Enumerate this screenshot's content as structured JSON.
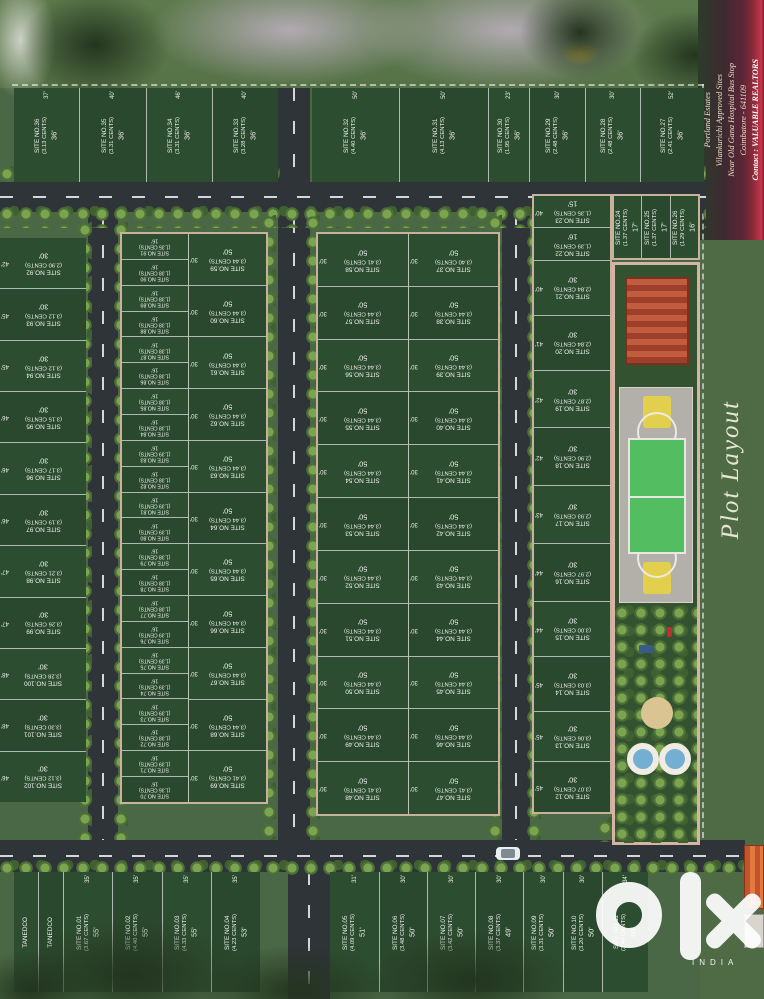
{
  "side_label": "Plot Layout",
  "watermark": {
    "brand": "olx",
    "country": "INDIA"
  },
  "banner": {
    "lines": [
      "Portland Estates",
      "Vilankurichi Approved Sites",
      "Near Old Gana Hospital Bus Stop",
      "Coimbatore - 641109",
      "Contact : VALUABLE REALTORS"
    ]
  },
  "plot_groups": {
    "top_left": [
      {
        "n": "SITE NO.36",
        "c": "(3.13 CENTS)",
        "f": "36'",
        "s": "37'"
      },
      {
        "n": "SITE NO.35",
        "c": "(3.31 CENTS)",
        "f": "36'",
        "s": "40'"
      },
      {
        "n": "SITE NO.34",
        "c": "(3.31 CENTS)",
        "f": "36'",
        "s": "46'"
      },
      {
        "n": "SITE NO.33",
        "c": "(3.28 CENTS)",
        "f": "36'",
        "s": "40'"
      }
    ],
    "top_right": [
      {
        "n": "SITE NO.32",
        "c": "(4.40 CENTS)",
        "f": "36'",
        "s": "50'"
      },
      {
        "n": "SITE NO.31",
        "c": "(4.13 CENTS)",
        "f": "36'",
        "s": "50'"
      },
      {
        "n": "SITE NO.30",
        "c": "(1.95 CENTS)",
        "f": "36'",
        "s": "23'"
      },
      {
        "n": "SITE NO.29",
        "c": "(2.48 CENTS)",
        "f": "36'",
        "s": "30'"
      },
      {
        "n": "SITE NO.28",
        "c": "(2.48 CENTS)",
        "f": "36'",
        "s": "30'"
      },
      {
        "n": "SITE NO.27",
        "c": "(2.41 CENTS)",
        "f": "36'",
        "s": "52'"
      }
    ],
    "left_col": [
      {
        "n": "SITE NO.92",
        "c": "(2.90 CENTS)",
        "f": "30'",
        "s": "42'"
      },
      {
        "n": "SITE NO.93",
        "c": "(3.12 CENTS)",
        "f": "30'",
        "s": "45'"
      },
      {
        "n": "SITE NO.94",
        "c": "(3.12 CENTS)",
        "f": "30'",
        "s": "45'"
      },
      {
        "n": "SITE NO.95",
        "c": "(3.15 CENTS)",
        "f": "30'",
        "s": "46'"
      },
      {
        "n": "SITE NO.96",
        "c": "(3.17 CENTS)",
        "f": "30'",
        "s": "46'"
      },
      {
        "n": "SITE NO.97",
        "c": "(3.19 CENTS)",
        "f": "30'",
        "s": "46'"
      },
      {
        "n": "SITE NO.98",
        "c": "(3.21 CENTS)",
        "f": "30'",
        "s": "47'"
      },
      {
        "n": "SITE NO.99",
        "c": "(3.26 CENTS)",
        "f": "30'",
        "s": "47'"
      },
      {
        "n": "SITE NO.100",
        "c": "(3.28 CENTS)",
        "f": "30'",
        "s": "48'"
      },
      {
        "n": "SITE NO.101",
        "c": "(3.30 CENTS)",
        "f": "30'",
        "s": "48'"
      },
      {
        "n": "SITE NO.102",
        "c": "(3.12 CENTS)",
        "f": "30'",
        "s": "46'"
      }
    ],
    "narrow_col": [
      {
        "n": "SITE NO.91",
        "c": "(1.35 CENTS)",
        "f": "16'"
      },
      {
        "n": "SITE NO.90",
        "c": "(1.38 CENTS)",
        "f": "16'"
      },
      {
        "n": "SITE NO.89",
        "c": "(1.38 CENTS)",
        "f": "16'"
      },
      {
        "n": "SITE NO.88",
        "c": "(1.38 CENTS)",
        "f": "16'"
      },
      {
        "n": "SITE NO.87",
        "c": "(1.38 CENTS)",
        "f": "16'"
      },
      {
        "n": "SITE NO.86",
        "c": "(1.38 CENTS)",
        "f": "16'"
      },
      {
        "n": "SITE NO.85",
        "c": "(1.38 CENTS)",
        "f": "16'"
      },
      {
        "n": "SITE NO.84",
        "c": "(1.38 CENTS)",
        "f": "16'"
      },
      {
        "n": "SITE NO.83",
        "c": "(1.39 CENTS)",
        "f": "16'"
      },
      {
        "n": "SITE NO.82",
        "c": "(1.38 CENTS)",
        "f": "16'"
      },
      {
        "n": "SITE NO.81",
        "c": "(1.39 CENTS)",
        "f": "16'"
      },
      {
        "n": "SITE NO.80",
        "c": "(1.39 CENTS)",
        "f": "16'"
      },
      {
        "n": "SITE NO.79",
        "c": "(1.38 CENTS)",
        "f": "16'"
      },
      {
        "n": "SITE NO.78",
        "c": "(1.38 CENTS)",
        "f": "16'"
      },
      {
        "n": "SITE NO.77",
        "c": "(1.38 CENTS)",
        "f": "16'"
      },
      {
        "n": "SITE NO.76",
        "c": "(1.39 CENTS)",
        "f": "16'"
      },
      {
        "n": "SITE NO.75",
        "c": "(1.39 CENTS)",
        "f": "16'"
      },
      {
        "n": "SITE NO.74",
        "c": "(1.39 CENTS)",
        "f": "16'"
      },
      {
        "n": "SITE NO.73",
        "c": "(1.39 CENTS)",
        "f": "16'"
      },
      {
        "n": "SITE NO.72",
        "c": "(1.38 CENTS)",
        "f": "16'"
      },
      {
        "n": "SITE NO.71",
        "c": "(1.39 CENTS)",
        "f": "16'"
      },
      {
        "n": "SITE NO.70",
        "c": "(1.36 CENTS)",
        "f": "16'"
      }
    ],
    "wide_col": [
      {
        "n": "SITE NO.59",
        "c": "(3.44 CENTS)",
        "d": "50'",
        "s": "30'"
      },
      {
        "n": "SITE NO.60",
        "c": "(3.44 CENTS)",
        "d": "50'",
        "s": "30'"
      },
      {
        "n": "SITE NO.61",
        "c": "(3.44 CENTS)",
        "d": "50'",
        "s": "30'"
      },
      {
        "n": "SITE NO.62",
        "c": "(3.44 CENTS)",
        "d": "50'",
        "s": "30'"
      },
      {
        "n": "SITE NO.63",
        "c": "(3.44 CENTS)",
        "d": "50'",
        "s": "30'"
      },
      {
        "n": "SITE NO.64",
        "c": "(3.44 CENTS)",
        "d": "50'",
        "s": "30'"
      },
      {
        "n": "SITE NO.65",
        "c": "(3.44 CENTS)",
        "d": "50'",
        "s": "30'"
      },
      {
        "n": "SITE NO.66",
        "c": "(3.44 CENTS)",
        "d": "50'",
        "s": "30'"
      },
      {
        "n": "SITE NO.67",
        "c": "(3.44 CENTS)",
        "d": "50'",
        "s": "30'"
      },
      {
        "n": "SITE NO.68",
        "c": "(3.44 CENTS)",
        "d": "50'",
        "s": "30'"
      },
      {
        "n": "SITE NO.69",
        "c": "(3.41 CENTS)",
        "d": "50'",
        "s": "30'"
      }
    ],
    "center_left": [
      {
        "n": "SITE NO.58",
        "c": "(3.41 CENTS)",
        "d": "50'",
        "s": "30'"
      },
      {
        "n": "SITE NO.57",
        "c": "(3.44 CENTS)",
        "d": "50'",
        "s": "30'"
      },
      {
        "n": "SITE NO.56",
        "c": "(3.44 CENTS)",
        "d": "50'",
        "s": "30'"
      },
      {
        "n": "SITE NO.55",
        "c": "(3.44 CENTS)",
        "d": "50'",
        "s": "30'"
      },
      {
        "n": "SITE NO.54",
        "c": "(3.44 CENTS)",
        "d": "50'",
        "s": "30'"
      },
      {
        "n": "SITE NO.53",
        "c": "(3.44 CENTS)",
        "d": "50'",
        "s": "30'"
      },
      {
        "n": "SITE NO.52",
        "c": "(3.44 CENTS)",
        "d": "50'",
        "s": "30'"
      },
      {
        "n": "SITE NO.51",
        "c": "(3.44 CENTS)",
        "d": "50'",
        "s": "30'"
      },
      {
        "n": "SITE NO.50",
        "c": "(3.44 CENTS)",
        "d": "50'",
        "s": "30'"
      },
      {
        "n": "SITE NO.49",
        "c": "(3.44 CENTS)",
        "d": "50'",
        "s": "30'"
      },
      {
        "n": "SITE NO.48",
        "c": "(3.41 CENTS)",
        "d": "50'",
        "s": "30'"
      }
    ],
    "center_right": [
      {
        "n": "SITE NO.37",
        "c": "(3.40 CENTS)",
        "d": "50'",
        "s": "30'"
      },
      {
        "n": "SITE NO.38",
        "c": "(3.44 CENTS)",
        "d": "50'",
        "s": "30'"
      },
      {
        "n": "SITE NO.39",
        "c": "(3.44 CENTS)",
        "d": "50'",
        "s": "30'"
      },
      {
        "n": "SITE NO.40",
        "c": "(3.44 CENTS)",
        "d": "50'",
        "s": "30'"
      },
      {
        "n": "SITE NO.41",
        "c": "(3.44 CENTS)",
        "d": "50'",
        "s": "30'"
      },
      {
        "n": "SITE NO.42",
        "c": "(3.44 CENTS)",
        "d": "50'",
        "s": "30'"
      },
      {
        "n": "SITE NO.43",
        "c": "(3.44 CENTS)",
        "d": "50'",
        "s": "30'"
      },
      {
        "n": "SITE NO.44",
        "c": "(3.44 CENTS)",
        "d": "50'",
        "s": "30'"
      },
      {
        "n": "SITE NO.45",
        "c": "(3.44 CENTS)",
        "d": "50'",
        "s": "30'"
      },
      {
        "n": "SITE NO.46",
        "c": "(3.44 CENTS)",
        "d": "50'",
        "s": "30'"
      },
      {
        "n": "SITE NO.47",
        "c": "(3.41 CENTS)",
        "d": "50'",
        "s": "30'"
      }
    ],
    "right_col": [
      {
        "n": "SITE NO.23",
        "c": "(1.35 CENTS)",
        "f": "15'",
        "s": "40'"
      },
      {
        "n": "SITE NO.22",
        "c": "(1.39 CENTS)",
        "f": "16'"
      },
      {
        "n": "SITE NO.21",
        "c": "(2.84 CENTS)",
        "f": "30'",
        "s": "40'"
      },
      {
        "n": "SITE NO.20",
        "c": "(2.84 CENTS)",
        "f": "30'",
        "s": "41'"
      },
      {
        "n": "SITE NO.19",
        "c": "(2.87 CENTS)",
        "f": "30'",
        "s": "42'"
      },
      {
        "n": "SITE NO.18",
        "c": "(2.90 CENTS)",
        "f": "30'",
        "s": "42'"
      },
      {
        "n": "SITE NO.17",
        "c": "(2.93 CENTS)",
        "f": "30'",
        "s": "43'"
      },
      {
        "n": "SITE NO.16",
        "c": "(2.97 CENTS)",
        "f": "30'",
        "s": "44'"
      },
      {
        "n": "SITE NO.15",
        "c": "(3.00 CENTS)",
        "f": "30'",
        "s": "44'"
      },
      {
        "n": "SITE NO.14",
        "c": "(3.03 CENTS)",
        "f": "30'",
        "s": "45'"
      },
      {
        "n": "SITE NO.13",
        "c": "(3.06 CENTS)",
        "f": "30'",
        "s": "45'"
      },
      {
        "n": "SITE NO.12",
        "c": "(3.07 CENTS)",
        "f": "30'",
        "s": "45'"
      }
    ],
    "right_small": [
      {
        "n": "SITE NO.24",
        "c": "(1.37 CENTS)",
        "f": "17'"
      },
      {
        "n": "SITE NO.25",
        "c": "(1.37 CENTS)",
        "f": "17'"
      },
      {
        "n": "SITE NO.26",
        "c": "(1.29 CENTS)",
        "f": "16'"
      }
    ],
    "bottom_left": [
      {
        "n": "TANEDCO"
      },
      {
        "n": "TANEDCO"
      },
      {
        "n": "SITE NO.01",
        "c": "(3.67 CENTS)",
        "d": "55'",
        "s": "35'"
      },
      {
        "n": "SITE NO.02",
        "c": "(4.40 CENTS)",
        "d": "55'",
        "s": "35'"
      },
      {
        "n": "SITE NO.03",
        "c": "(4.33 CENTS)",
        "d": "55'",
        "s": "35'"
      },
      {
        "n": "SITE NO.04",
        "c": "(4.23 CENTS)",
        "d": "53'",
        "s": "35'"
      }
    ],
    "bottom_right": [
      {
        "n": "SITE NO.05",
        "c": "(4.09 CENTS)",
        "d": "51'",
        "s": "31'"
      },
      {
        "n": "SITE NO.06",
        "c": "(3.48 CENTS)",
        "d": "50'",
        "s": "30'"
      },
      {
        "n": "SITE NO.07",
        "c": "(3.42 CENTS)",
        "d": "50'",
        "s": "30'"
      },
      {
        "n": "SITE NO.08",
        "c": "(3.37 CENTS)",
        "d": "49'",
        "s": "30'"
      },
      {
        "n": "SITE NO.09",
        "c": "(3.31 CENTS)",
        "d": "50'",
        "s": "30'"
      },
      {
        "n": "SITE NO.10",
        "c": "(3.20 CENTS)",
        "d": "50'",
        "s": "30'"
      },
      {
        "n": "SITE NO.11",
        "c": "(3.44 CENTS)",
        "d": "50'",
        "s": "34'"
      }
    ]
  }
}
